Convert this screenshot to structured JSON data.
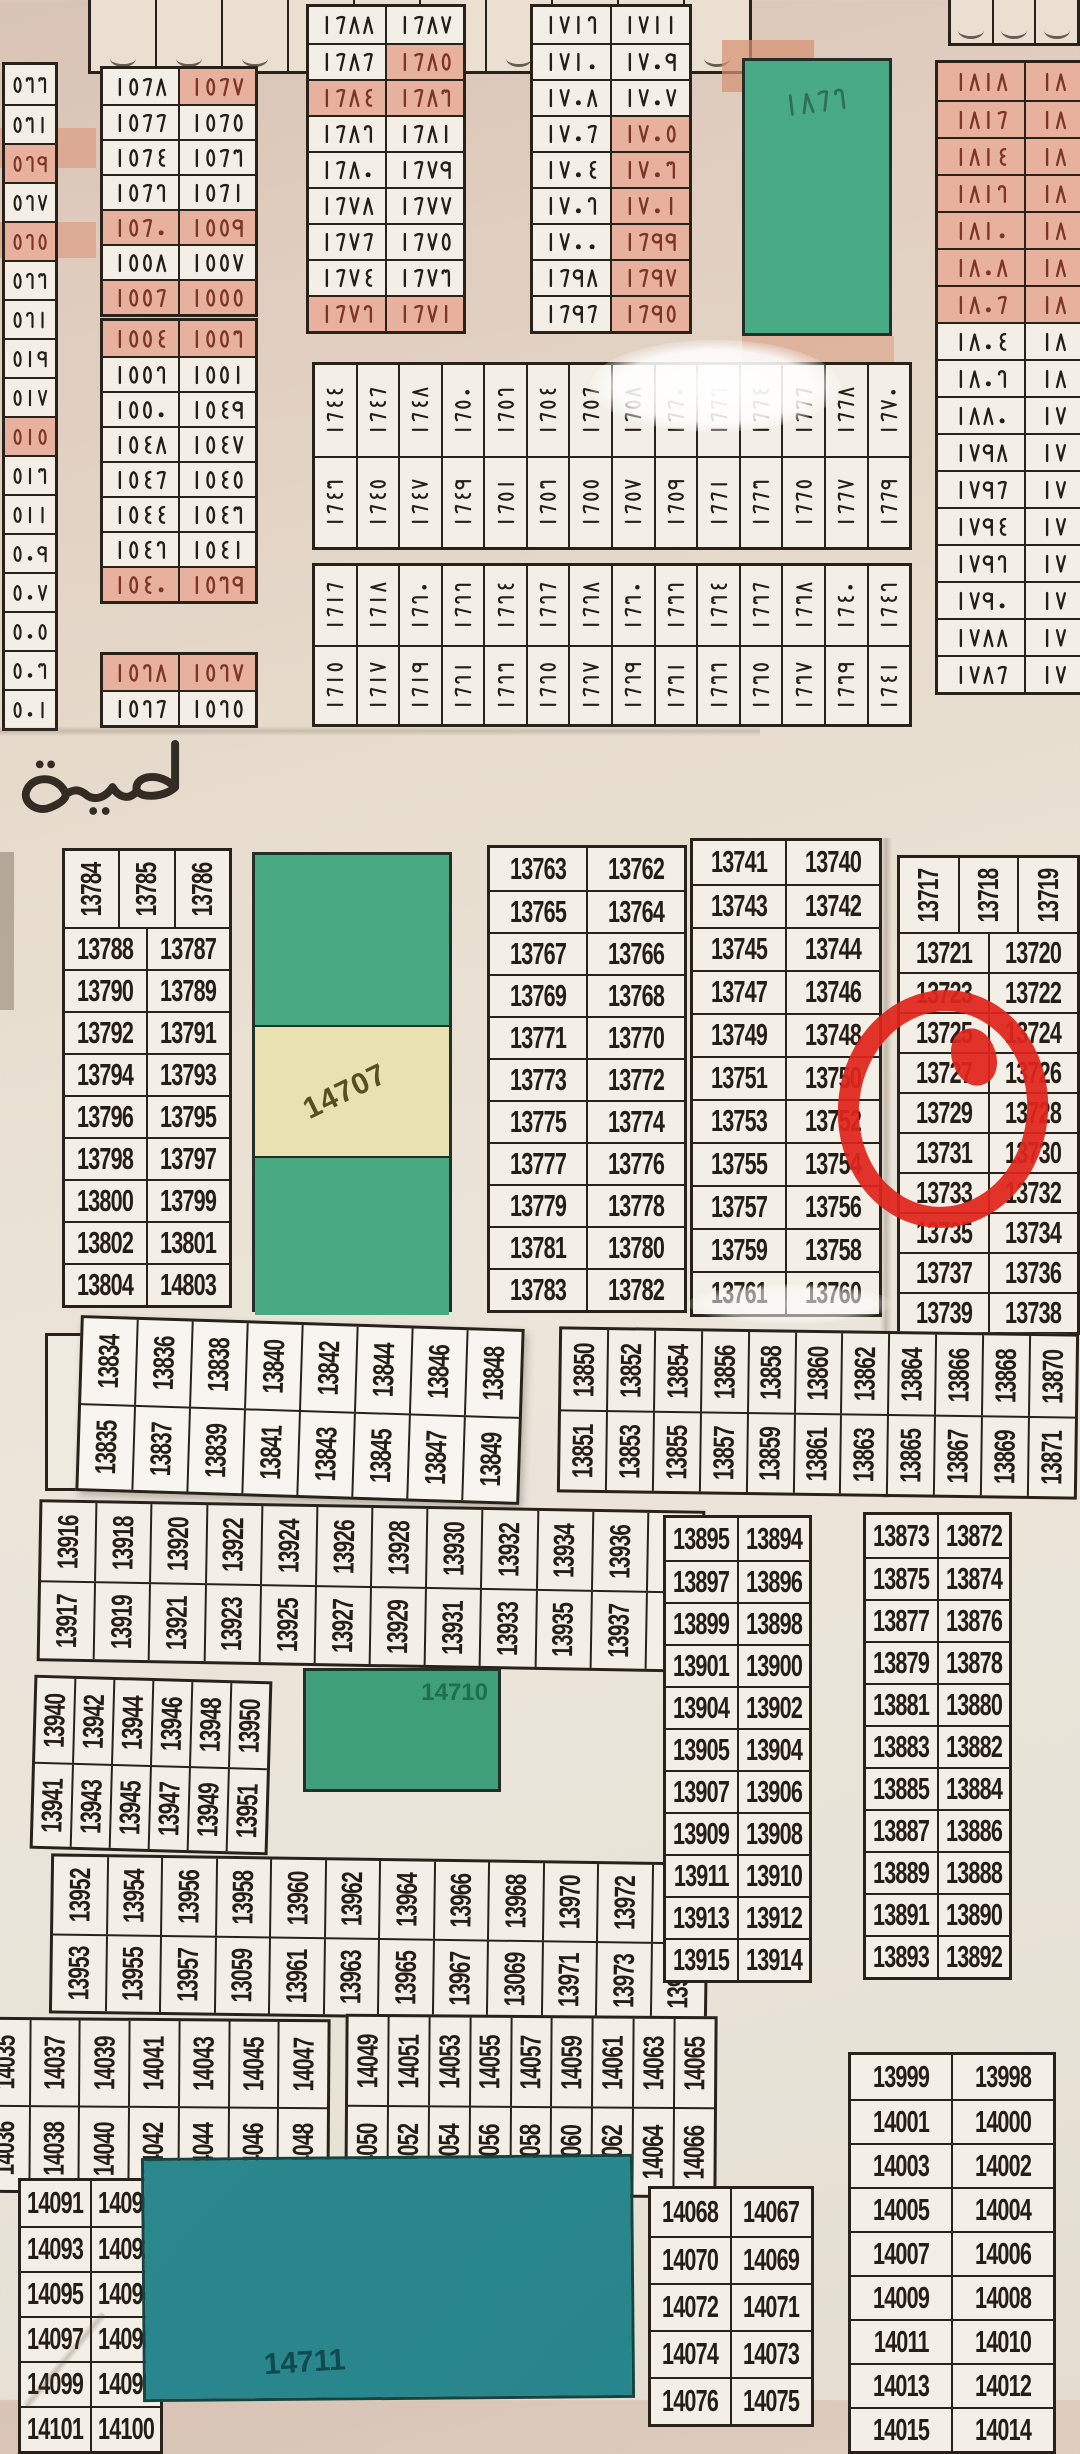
{
  "canvas": {
    "width": 1080,
    "height": 2400
  },
  "road_label": "طريق",
  "annotation": {
    "red_circle_marked_plots": "13729, 13731"
  },
  "top": {
    "strip_left": {
      "x": 88,
      "y": 0,
      "w": 664,
      "h": 74,
      "cells": 10
    },
    "strip_right": {
      "x": 948,
      "y": 0,
      "w": 132,
      "h": 46,
      "cells": 3
    },
    "left_column": {
      "x": 2,
      "y": 62,
      "w": 56,
      "rowH": 39,
      "values": [
        "٥٣٣",
        "٥٣١",
        "٥٢٩",
        "٥٢٧",
        "٥٢٥",
        "٥٢٣",
        "٥٢١",
        "٥١٩",
        "٥١٧",
        "٥١٥",
        "٥١٣",
        "٥١١",
        "٥٠٩",
        "٥٠٧",
        "٥٠٥",
        "٥٠٣",
        "٥٠١"
      ],
      "hl": [
        "٥٢٩",
        "٥٢٥",
        "٥١٥"
      ]
    },
    "block_1568": {
      "x": 100,
      "y": 66,
      "w": 158,
      "rowH": 35,
      "rows": [
        [
          "١٥٦٨",
          "١٥٦٧"
        ],
        [
          "١٥٦٦",
          "١٥٦٥"
        ],
        [
          "١٥٦٤",
          "١٥٦٣"
        ],
        [
          "١٥٦٢",
          "١٥٦١"
        ],
        [
          "١٥٦٠",
          "١٥٥٩"
        ],
        [
          "١٥٥٨",
          "١٥٥٧"
        ],
        [
          "١٥٥٦",
          "١٥٥٥"
        ]
      ],
      "hl": [
        "١٥٦٧"
      ],
      "hlRows": [
        4,
        6
      ]
    },
    "block_1554": {
      "x": 100,
      "y": 318,
      "w": 158,
      "rowH": 35,
      "rows": [
        [
          "١٥٥٤",
          "١٥٥٣"
        ],
        [
          "١٥٥٢",
          "١٥٥١"
        ],
        [
          "١٥٥٠",
          "١٥٤٩"
        ],
        [
          "١٥٤٨",
          "١٥٤٧"
        ],
        [
          "١٥٤٦",
          "١٥٤٥"
        ],
        [
          "١٥٤٤",
          "١٥٤٣"
        ],
        [
          "١٥٤٢",
          "١٥٤١"
        ],
        [
          "١٥٤٠",
          "١٥٣٩"
        ]
      ],
      "hlRows": [
        0,
        7
      ]
    },
    "block_1528": {
      "x": 100,
      "y": 652,
      "w": 158,
      "rowH": 35,
      "rows": [
        [
          "١٥٢٨",
          "١٥٢٧"
        ],
        [
          "١٥٢٦",
          "١٥٢٥"
        ]
      ],
      "hlRows": [
        0
      ]
    },
    "block_1688": {
      "x": 306,
      "y": 4,
      "w": 160,
      "rowH": 36,
      "rows": [
        [
          "١٦٨٨",
          "١٦٨٧"
        ],
        [
          "١٦٨٦",
          "١٦٨٥"
        ],
        [
          "١٦٨٤",
          "١٦٨٣"
        ],
        [
          "١٦٨٢",
          "١٦٨١"
        ],
        [
          "١٦٨٠",
          "١٦٧٩"
        ],
        [
          "١٦٧٨",
          "١٦٧٧"
        ],
        [
          "١٦٧٦",
          "١٦٧٥"
        ],
        [
          "١٦٧٤",
          "١٦٧٣"
        ],
        [
          "١٦٧٢",
          "١٦٧١"
        ]
      ],
      "hl": [
        "١٦٨٥",
        "١٦٨٤",
        "١٦٨٣"
      ],
      "hlRows": [
        8
      ]
    },
    "block_1712": {
      "x": 530,
      "y": 4,
      "w": 162,
      "rowH": 36,
      "rows": [
        [
          "١٧١٢",
          "١٧١١"
        ],
        [
          "١٧١٠",
          "١٧٠٩"
        ],
        [
          "١٧٠٨",
          "١٧٠٧"
        ],
        [
          "١٧٠٦",
          "١٧٠٥"
        ],
        [
          "١٧٠٤",
          "١٧٠٣"
        ],
        [
          "١٧٠٢",
          "١٧٠١"
        ],
        [
          "١٧٠٠",
          "١٦٩٩"
        ],
        [
          "١٦٩٨",
          "١٦٩٧"
        ],
        [
          "١٦٩٦",
          "١٦٩٥"
        ]
      ],
      "hl": [
        "١٧٠٥",
        "١٧٠٣",
        "١٧٠١",
        "١٦٩٩",
        "١٦٩٧",
        "١٦٩٥"
      ]
    },
    "green_1862": {
      "x": 742,
      "y": 58,
      "w": 150,
      "h": 278,
      "label": "١٨٦٢",
      "color": "#49ab85",
      "label_color": "#2f7054"
    },
    "block_1818": {
      "x": 935,
      "y": 60,
      "w": 150,
      "rowH": 37,
      "split": [
        0.6,
        0.4
      ],
      "rows": [
        [
          "١٨١٨",
          "١٨"
        ],
        [
          "١٨١٦",
          "١٨"
        ],
        [
          "١٨١٤",
          "١٨"
        ],
        [
          "١٨١٢",
          "١٨"
        ],
        [
          "١٨١٠",
          "١٨"
        ],
        [
          "١٨٠٨",
          "١٨"
        ],
        [
          "١٨٠٦",
          "١٨"
        ],
        [
          "١٨٠٤",
          "١٨"
        ],
        [
          "١٨٠٢",
          "١٨"
        ],
        [
          "١٨٨٠",
          "١٧"
        ],
        [
          "١٧٩٨",
          "١٧"
        ],
        [
          "١٧٩٦",
          "١٧"
        ],
        [
          "١٧٩٤",
          "١٧"
        ],
        [
          "١٧٩٢",
          "١٧"
        ],
        [
          "١٧٩٠",
          "١٧"
        ],
        [
          "١٧٨٨",
          "١٧"
        ],
        [
          "١٧٨٦",
          "١٧"
        ]
      ],
      "hlRows": [
        0,
        1,
        2,
        3,
        4,
        5,
        6
      ]
    },
    "band_1644": {
      "x": 312,
      "y": 362,
      "w": 600,
      "rowH": 91,
      "top": [
        "١٦٤٤",
        "١٦٤٦",
        "١٦٤٨",
        "١٦٥٠",
        "١٦٥٢",
        "١٦٥٤",
        "١٦٥٦",
        "١٦٥٨",
        "١٦٦٠",
        "١٦٦٢",
        "١٦٦٤",
        "١٦٦٦",
        "١٦٦٨",
        "١٦٧٠"
      ],
      "bottom": [
        "١٦٤٣",
        "١٦٤٥",
        "١٦٤٧",
        "١٦٤٩",
        "١٦٥١",
        "١٦٥٣",
        "١٦٥٥",
        "١٦٥٧",
        "١٦٥٩",
        "١٦٦١",
        "١٦٦٣",
        "١٦٦٥",
        "١٦٦٧",
        "١٦٦٩"
      ]
    },
    "band_1616": {
      "x": 312,
      "y": 563,
      "w": 600,
      "rowH": 79,
      "top": [
        "١٦١٦",
        "١٦١٨",
        "١٦٢٠",
        "١٦٢٢",
        "١٦٢٤",
        "١٦٢٦",
        "١٦٢٨",
        "١٦٣٠",
        "١٦٣٢",
        "١٦٣٤",
        "١٦٣٦",
        "١٦٣٨",
        "١٦٤٠",
        "١٦٤٢"
      ],
      "bottom": [
        "١٦١٥",
        "١٦١٧",
        "١٦١٩",
        "١٦٢١",
        "١٦٢٣",
        "١٦٢٥",
        "١٦٢٧",
        "١٦٢٩",
        "١٦٣١",
        "١٦٣٣",
        "١٦٣٥",
        "١٦٣٧",
        "١٦٣٩",
        "١٦٤١"
      ]
    }
  },
  "mid": {
    "block_13784": {
      "x": 62,
      "y": 848,
      "w": 170,
      "rowH": 42,
      "rotH": 76,
      "en": true,
      "rotTop": [
        "13784",
        "13785",
        "13786"
      ],
      "rows": [
        [
          "13788",
          "13787"
        ],
        [
          "13790",
          "13789"
        ],
        [
          "13792",
          "13791"
        ],
        [
          "13794",
          "13793"
        ],
        [
          "13796",
          "13795"
        ],
        [
          "13798",
          "13797"
        ],
        [
          "13800",
          "13799"
        ],
        [
          "13802",
          "13801"
        ],
        [
          "13804",
          "14803"
        ]
      ]
    },
    "green_14707": {
      "x": 252,
      "y": 852,
      "w": 200,
      "h": 460,
      "label": "14707",
      "seg": [
        170,
        133,
        157
      ],
      "green": "#48a983",
      "beige": "#e9e1b2",
      "label_color": "#55511f"
    },
    "block_13763": {
      "x": 487,
      "y": 845,
      "w": 200,
      "rowH": 42,
      "en": true,
      "rows": [
        [
          "13763",
          "13762"
        ],
        [
          "13765",
          "13764"
        ],
        [
          "13767",
          "13766"
        ],
        [
          "13769",
          "13768"
        ],
        [
          "13771",
          "13770"
        ],
        [
          "13773",
          "13772"
        ],
        [
          "13775",
          "13774"
        ],
        [
          "13777",
          "13776"
        ],
        [
          "13779",
          "13778"
        ],
        [
          "13781",
          "13780"
        ],
        [
          "13783",
          "13782"
        ]
      ]
    },
    "block_13741": {
      "x": 690,
      "y": 838,
      "w": 192,
      "rowH": 43,
      "en": true,
      "rows": [
        [
          "13741",
          "13740"
        ],
        [
          "13743",
          "13742"
        ],
        [
          "13745",
          "13744"
        ],
        [
          "13747",
          "13746"
        ],
        [
          "13749",
          "13748"
        ],
        [
          "13751",
          "13750"
        ],
        [
          "13753",
          "13752"
        ],
        [
          "13755",
          "13754"
        ],
        [
          "13757",
          "13756"
        ],
        [
          "13759",
          "13758"
        ],
        [
          "13761",
          "13760"
        ]
      ]
    },
    "block_13717": {
      "x": 897,
      "y": 855,
      "w": 183,
      "rowH": 40,
      "rotH": 74,
      "en": true,
      "rotTop": [
        "13717",
        "13718",
        "13719"
      ],
      "rows": [
        [
          "13721",
          "13720"
        ],
        [
          "13723",
          "13722"
        ],
        [
          "13725",
          "13724"
        ],
        [
          "13727",
          "13726"
        ],
        [
          "13729",
          "13728"
        ],
        [
          "13731",
          "13730"
        ],
        [
          "13733",
          "13732"
        ],
        [
          "13735",
          "13734"
        ],
        [
          "13737",
          "13736"
        ],
        [
          "13739",
          "13738"
        ]
      ]
    },
    "band_13834": {
      "x": 78,
      "y": 1322,
      "w": 444,
      "rowH": 85,
      "rot": 1.8,
      "en": true,
      "sticker": true,
      "top": [
        "13834",
        "13836",
        "13838",
        "13840",
        "13842",
        "13844",
        "13846",
        "13848"
      ],
      "bottom": [
        "13835",
        "13837",
        "13839",
        "13841",
        "13843",
        "13845",
        "13847",
        "13849"
      ]
    },
    "band_13850": {
      "x": 558,
      "y": 1330,
      "w": 520,
      "rowH": 80,
      "rot": 0.8,
      "en": true,
      "top": [
        "13850",
        "13852",
        "13854",
        "13856",
        "13858",
        "13860",
        "13862",
        "13864",
        "13866",
        "13868",
        "13870"
      ],
      "bottom": [
        "13851",
        "13853",
        "13855",
        "13857",
        "13859",
        "13861",
        "13863",
        "13865",
        "13867",
        "13869",
        "13871"
      ]
    },
    "band_13916": {
      "x": 38,
      "y": 1505,
      "w": 666,
      "rowH": 78,
      "rot": 1.0,
      "en": true,
      "top": [
        "13916",
        "13918",
        "13920",
        "13922",
        "13924",
        "13926",
        "13928",
        "13930",
        "13932",
        "13934",
        "13936",
        "13938"
      ],
      "bottom": [
        "13917",
        "13919",
        "13921",
        "13923",
        "13925",
        "13927",
        "13929",
        "13931",
        "13933",
        "13935",
        "13937",
        "13939"
      ]
    },
    "band_13940": {
      "x": 32,
      "y": 1678,
      "w": 238,
      "rowH": 84,
      "rot": 1.6,
      "en": true,
      "top": [
        "13940",
        "13942",
        "13944",
        "13946",
        "13948",
        "13950"
      ],
      "bottom": [
        "13941",
        "13943",
        "13945",
        "13947",
        "13949",
        "13951"
      ]
    },
    "green_14710": {
      "x": 303,
      "y": 1668,
      "w": 198,
      "h": 124,
      "label": "14710",
      "color": "#3f9f78",
      "label_color": "#1f6e4e"
    },
    "band_13952": {
      "x": 50,
      "y": 1858,
      "w": 658,
      "rowH": 77,
      "rot": 0.8,
      "en": true,
      "top": [
        "13952",
        "13954",
        "13956",
        "13958",
        "13960",
        "13962",
        "13964",
        "13966",
        "13968",
        "13970",
        "13972",
        "13974"
      ],
      "bottom": [
        "13953",
        "13955",
        "13957",
        "13059",
        "13961",
        "13963",
        "13965",
        "13967",
        "13069",
        "13971",
        "13973",
        "13975"
      ]
    },
    "block_13895": {
      "x": 663,
      "y": 1515,
      "w": 149,
      "rowH": 42,
      "en": true,
      "rows": [
        [
          "13895",
          "13894"
        ],
        [
          "13897",
          "13896"
        ],
        [
          "13899",
          "13898"
        ],
        [
          "13901",
          "13900"
        ],
        [
          "13904",
          "13902"
        ],
        [
          "13905",
          "13904"
        ],
        [
          "13907",
          "13906"
        ],
        [
          "13909",
          "13908"
        ],
        [
          "13911",
          "13910"
        ],
        [
          "13913",
          "13912"
        ],
        [
          "13915",
          "13914"
        ]
      ]
    },
    "block_13873": {
      "x": 863,
      "y": 1512,
      "w": 149,
      "rowH": 42,
      "en": true,
      "rows": [
        [
          "13873",
          "13872"
        ],
        [
          "13875",
          "13874"
        ],
        [
          "13877",
          "13876"
        ],
        [
          "13879",
          "13878"
        ],
        [
          "13881",
          "13880"
        ],
        [
          "13883",
          "13882"
        ],
        [
          "13885",
          "13884"
        ],
        [
          "13887",
          "13886"
        ],
        [
          "13889",
          "13888"
        ],
        [
          "13891",
          "13890"
        ],
        [
          "13893",
          "13892"
        ]
      ]
    }
  },
  "bottom": {
    "band_14035": {
      "x": -22,
      "y": 2018,
      "w": 352,
      "rowH": 85,
      "rot": 0.4,
      "en": true,
      "top": [
        "14035",
        "14037",
        "14039",
        "14041",
        "14043",
        "14045",
        "14047"
      ],
      "bottom": [
        "14036",
        "14038",
        "14040",
        "14042",
        "14044",
        "14046",
        "14048"
      ]
    },
    "band_14049": {
      "x": 345,
      "y": 2015,
      "w": 372,
      "rowH": 88,
      "rot": 0.4,
      "en": true,
      "top": [
        "14049",
        "14051",
        "14053",
        "14055",
        "14057",
        "14059",
        "14061",
        "14063",
        "14065"
      ],
      "bottom": [
        "14050",
        "14052",
        "14054",
        "14056",
        "14058",
        "14060",
        "14062",
        "14064",
        "14066"
      ]
    },
    "block_14091": {
      "x": 18,
      "y": 2178,
      "w": 145,
      "rowH": 45,
      "en": true,
      "rows": [
        [
          "14091",
          "14090"
        ],
        [
          "14093",
          "14092"
        ],
        [
          "14095",
          "14094"
        ],
        [
          "14097",
          "14096"
        ],
        [
          "14099",
          "14098"
        ],
        [
          "14101",
          "14100"
        ]
      ]
    },
    "teal_14711": {
      "x": 142,
      "y": 2156,
      "w": 492,
      "h": 244,
      "label": "14711",
      "color": "#2b878e",
      "label_color": "#0f4a50"
    },
    "block_14068": {
      "x": 648,
      "y": 2186,
      "w": 166,
      "rowH": 47,
      "en": true,
      "rows": [
        [
          "14068",
          "14067"
        ],
        [
          "14070",
          "14069"
        ],
        [
          "14072",
          "14071"
        ],
        [
          "14074",
          "14073"
        ],
        [
          "14076",
          "14075"
        ]
      ]
    },
    "block_13999": {
      "x": 848,
      "y": 2052,
      "w": 208,
      "rowH": 44,
      "en": true,
      "rows": [
        [
          "13999",
          "13998"
        ],
        [
          "14001",
          "14000"
        ],
        [
          "14003",
          "14002"
        ],
        [
          "14005",
          "14004"
        ],
        [
          "14007",
          "14006"
        ],
        [
          "14009",
          "14008"
        ],
        [
          "14011",
          "14010"
        ],
        [
          "14013",
          "14012"
        ],
        [
          "14015",
          "14014"
        ]
      ]
    }
  }
}
